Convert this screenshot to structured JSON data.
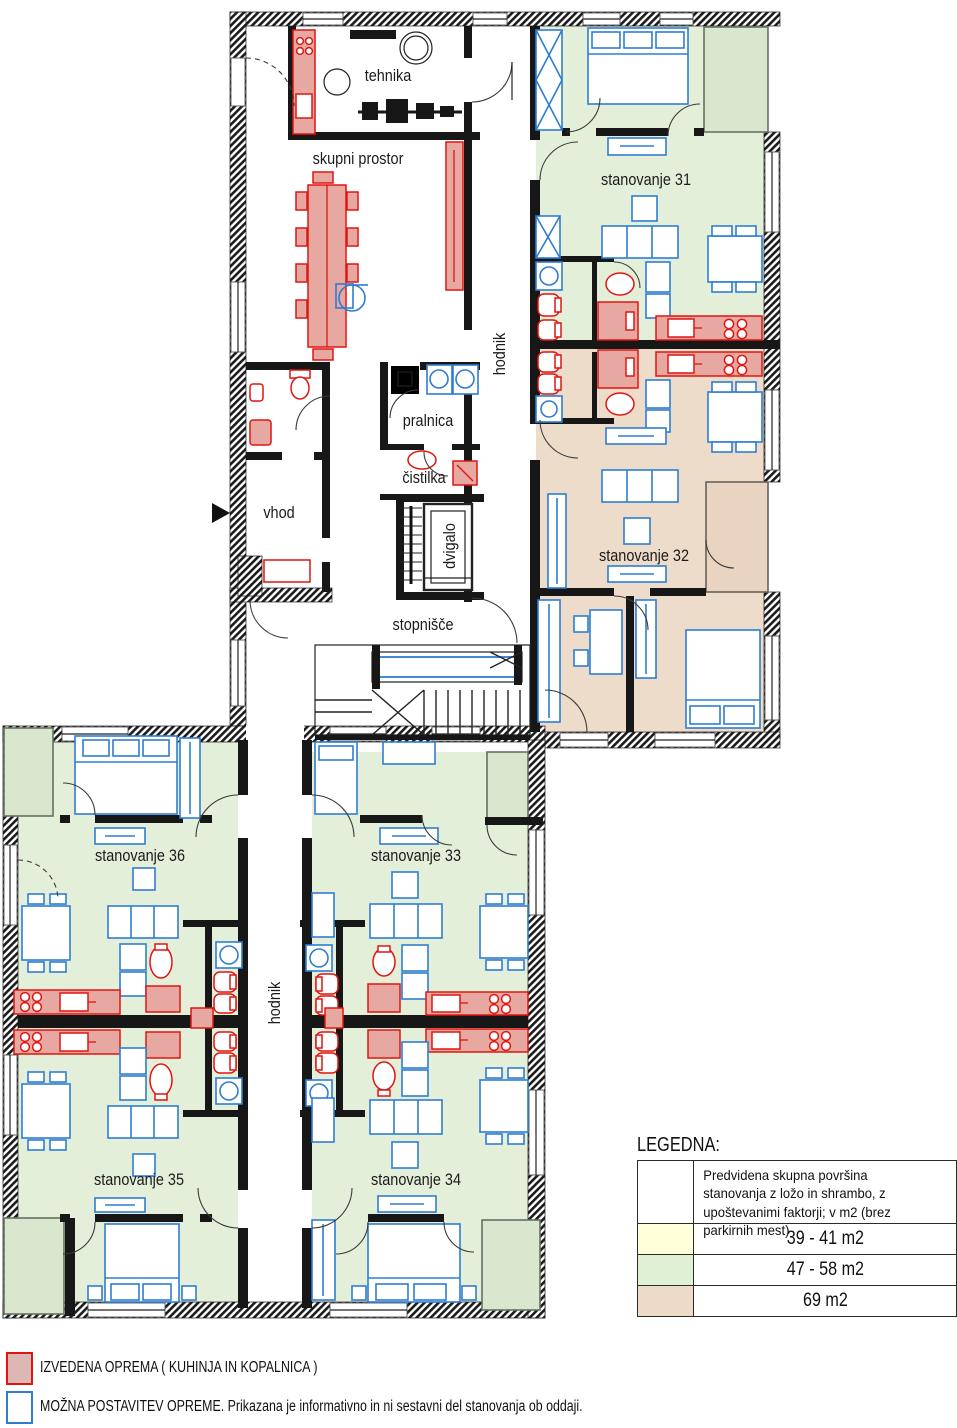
{
  "rooms": {
    "tehnika": "tehnika",
    "skupni_prostor": "skupni prostor",
    "hodnik_zgoraj": "hodnik",
    "pralnica": "pralnica",
    "cistilka": "čistilka",
    "vhod": "vhod",
    "dvigalo": "dvigalo",
    "stopnisce": "stopnišče",
    "hodnik_spodaj": "hodnik",
    "st31": "stanovanje 31",
    "st32": "stanovanje 32",
    "st33": "stanovanje 33",
    "st34": "stanovanje 34",
    "st35": "stanovanje 35",
    "st36": "stanovanje 36"
  },
  "legend": {
    "title": "LEGEDNA:",
    "header": "Predvidena skupna površina stanovanja z ložo in shrambo, z upoštevanimi faktorji; v m2 (brez parkirnih mest)",
    "rows": [
      {
        "label": "39 - 41 m2",
        "color": "#feffd9"
      },
      {
        "label": "47 - 58 m2",
        "color": "#dff0d4"
      },
      {
        "label": "69 m2",
        "color": "#eedbc7"
      }
    ]
  },
  "key": {
    "izvedena": "IZVEDENA OPREMA ( KUHINJA IN KOPALNICA )",
    "mozna": "MOŽNA POSTAVITEV OPREME. Prikazana je informativno in ni sestavni del stanovanja ob oddaji.",
    "izvedena_color": "#e01510",
    "mozna_color": "#2e7dd2"
  },
  "colors": {
    "apartment_green": "#e4efda",
    "apartment_tan": "#eddcca",
    "balcony_green": "#d9e7cf",
    "balcony_tan": "#e8d4c1",
    "furniture_blue": "#2e7dd2",
    "equipment_red": "#e01510",
    "equipment_red_fill": "#e7a8a1",
    "wall_black": "#171717"
  }
}
